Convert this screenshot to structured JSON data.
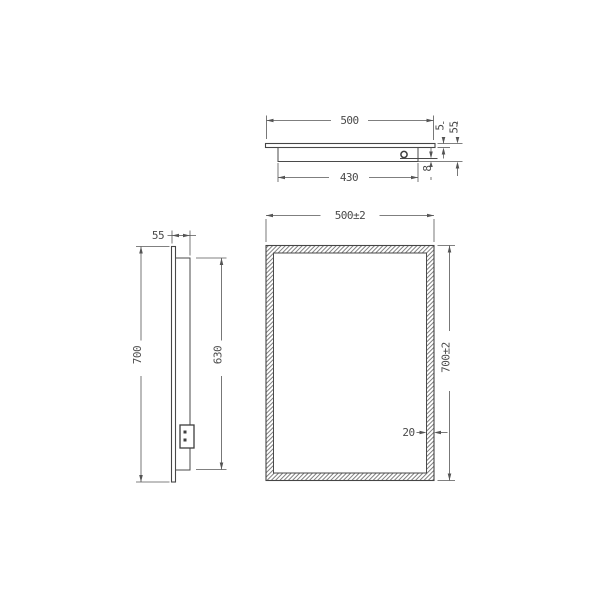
{
  "colors": {
    "background": "#ffffff",
    "line": "#454545",
    "dimension_line": "#565656",
    "hatch": "#808080",
    "text": "#4a4a4a"
  },
  "views": {
    "top": {
      "label": "top-view",
      "dims": {
        "width": "500",
        "box_width": "430",
        "glass_thickness": "5",
        "total_depth": "55",
        "bracket_gap": "8"
      }
    },
    "side": {
      "label": "side-view",
      "dims": {
        "depth": "55",
        "height": "700",
        "box_height": "630"
      }
    },
    "front": {
      "label": "front-view",
      "dims": {
        "width": "500±2",
        "height": "700±2",
        "frame_width": "20"
      }
    }
  }
}
